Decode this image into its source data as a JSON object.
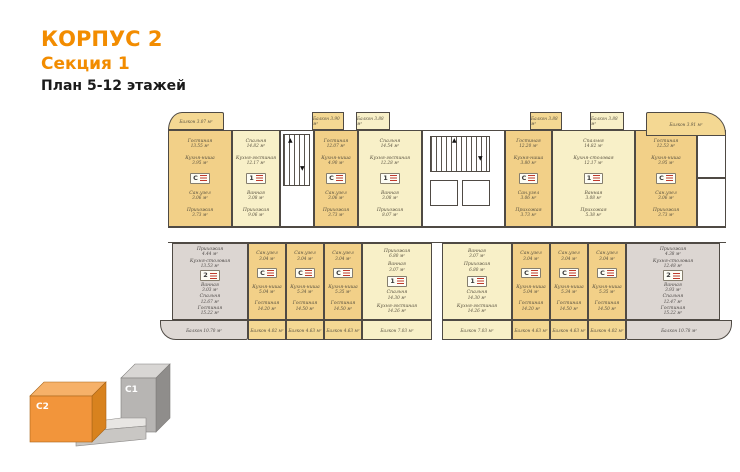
{
  "header": {
    "building": "КОРПУС 2",
    "section": "Секция 1",
    "plan_label": "План 5-12 этажей"
  },
  "key_plan": {
    "c2_label": "C2",
    "c1_label": "C1",
    "c2_color": "#F2953B",
    "c1_color": "#B7B5B3"
  },
  "plan": {
    "units": [
      {
        "id": "t1",
        "badge": "С",
        "rooms": [
          {
            "n": "Гостиная",
            "a": "13.55 м²"
          },
          {
            "n": "Кухня-ниша",
            "a": "3.95 м²"
          },
          {
            "n": "Сан.узел",
            "a": "3.06 м²"
          },
          {
            "n": "Прихожая",
            "a": "3.73 м²"
          }
        ]
      },
      {
        "id": "t2",
        "badge": "1",
        "rooms": [
          {
            "n": "Спальня",
            "a": "14.82 м²"
          },
          {
            "n": "Кухня-гостиная",
            "a": "12.17 м²"
          },
          {
            "n": "Ванная",
            "a": "3.08 м²"
          },
          {
            "n": "Прихожая",
            "a": "9.06 м²"
          }
        ]
      },
      {
        "id": "t3",
        "badge": "С",
        "rooms": [
          {
            "n": "Гостиная",
            "a": "12.07 м²"
          },
          {
            "n": "Кухня-ниша",
            "a": "4.90 м²"
          },
          {
            "n": "Сан.узел",
            "a": "3.06 м²"
          },
          {
            "n": "Прихожая",
            "a": "3.73 м²"
          }
        ]
      },
      {
        "id": "t4",
        "badge": "1",
        "rooms": [
          {
            "n": "Спальня",
            "a": "14.54 м²"
          },
          {
            "n": "Кухня-гостиная",
            "a": "12.28 м²"
          },
          {
            "n": "Ванная",
            "a": "3.08 м²"
          },
          {
            "n": "Прихожая",
            "a": "8.07 м²"
          }
        ]
      },
      {
        "id": "t5",
        "badge": "С",
        "rooms": [
          {
            "n": "Гостиная",
            "a": "12.20 м²"
          },
          {
            "n": "Кухня-ниша",
            "a": "3.80 м²"
          },
          {
            "n": "Сан.узел",
            "a": "3.06 м²"
          },
          {
            "n": "Прихожая",
            "a": "3.73 м²"
          }
        ]
      },
      {
        "id": "t6",
        "badge": "1",
        "rooms": [
          {
            "n": "Спальня",
            "a": "14.82 м²"
          },
          {
            "n": "Кухня-столовая",
            "a": "12.17 м²"
          },
          {
            "n": "Ванная",
            "a": "3.08 м²"
          },
          {
            "n": "Прихожая",
            "a": "5.38 м²"
          }
        ]
      },
      {
        "id": "t7",
        "badge": "С",
        "rooms": [
          {
            "n": "Гостиная",
            "a": "12.53 м²"
          },
          {
            "n": "Кухня-ниша",
            "a": "3.95 м²"
          },
          {
            "n": "Сан.узел",
            "a": "3.06 м²"
          },
          {
            "n": "Прихожая",
            "a": "3.73 м²"
          }
        ]
      },
      {
        "id": "g1",
        "badge": "2",
        "rooms": [
          {
            "n": "Прихожая",
            "a": "4.44 м²"
          },
          {
            "n": "Кухня-столовая",
            "a": "13.53 м²"
          },
          {
            "n": "Ванная",
            "a": "3.03 м²"
          },
          {
            "n": "Спальня",
            "a": "12.67 м²"
          },
          {
            "n": "Гостиная",
            "a": "15.22 м²"
          }
        ]
      },
      {
        "id": "s1",
        "badge": "С",
        "rooms": [
          {
            "n": "Сан.узел",
            "a": "3.04 м²"
          },
          {
            "n": "Кухня-ниша",
            "a": "5.04 м²"
          },
          {
            "n": "Гостиная",
            "a": "14.20 м²"
          }
        ]
      },
      {
        "id": "s2",
        "badge": "С",
        "rooms": [
          {
            "n": "Сан.узел",
            "a": "3.04 м²"
          },
          {
            "n": "Кухня-ниша",
            "a": "5.34 м²"
          },
          {
            "n": "Гостиная",
            "a": "14.50 м²"
          }
        ]
      },
      {
        "id": "s3",
        "badge": "С",
        "rooms": [
          {
            "n": "Сан.узел",
            "a": "3.04 м²"
          },
          {
            "n": "Кухня-ниша",
            "a": "5.35 м²"
          },
          {
            "n": "Гостиная",
            "a": "14.50 м²"
          }
        ]
      },
      {
        "id": "o1",
        "badge": "1",
        "rooms": [
          {
            "n": "Прихожая",
            "a": "6.80 м²"
          },
          {
            "n": "Ванная",
            "a": "3.07 м²"
          },
          {
            "n": "Спальня",
            "a": "14.30 м²"
          },
          {
            "n": "Кухня-гостиная",
            "a": "14.26 м²"
          }
        ]
      },
      {
        "id": "o2",
        "badge": "1",
        "rooms": [
          {
            "n": "Ванная",
            "a": "3.07 м²"
          },
          {
            "n": "Прихожая",
            "a": "6.80 м²"
          },
          {
            "n": "Спальня",
            "a": "14.30 м²"
          },
          {
            "n": "Кухня-гостиная",
            "a": "14.26 м²"
          }
        ]
      },
      {
        "id": "s4",
        "badge": "С",
        "rooms": [
          {
            "n": "Сан.узел",
            "a": "3.04 м²"
          },
          {
            "n": "Кухня-ниша",
            "a": "5.04 м²"
          },
          {
            "n": "Гостиная",
            "a": "14.20 м²"
          }
        ]
      },
      {
        "id": "s5",
        "badge": "С",
        "rooms": [
          {
            "n": "Сан.узел",
            "a": "3.04 м²"
          },
          {
            "n": "Кухня-ниша",
            "a": "5.34 м²"
          },
          {
            "n": "Гостиная",
            "a": "14.50 м²"
          }
        ]
      },
      {
        "id": "s6",
        "badge": "С",
        "rooms": [
          {
            "n": "Сан.узел",
            "a": "3.04 м²"
          },
          {
            "n": "Кухня-ниша",
            "a": "5.35 м²"
          },
          {
            "n": "Гостиная",
            "a": "14.50 м²"
          }
        ]
      },
      {
        "id": "g2",
        "badge": "2",
        "rooms": [
          {
            "n": "Прихожая",
            "a": "4.38 м²"
          },
          {
            "n": "Кухня-столовая",
            "a": "12.48 м²"
          },
          {
            "n": "Ванная",
            "a": "3.93 м²"
          },
          {
            "n": "Спальня",
            "a": "12.47 м²"
          },
          {
            "n": "Гостиная",
            "a": "15.22 м²"
          }
        ]
      }
    ],
    "balconies": [
      {
        "id": "tb1",
        "label": "Балкон",
        "area": "3.07 м²",
        "tone": "gold"
      },
      {
        "id": "tb2",
        "label": "Балкон",
        "area": "3.90 м²",
        "tone": "gold"
      },
      {
        "id": "tb3",
        "label": "Балкон",
        "area": "3.88 м²",
        "tone": "pale"
      },
      {
        "id": "tb4",
        "label": "Балкон",
        "area": "3.88 м²",
        "tone": "gold"
      },
      {
        "id": "tb5",
        "label": "Балкон",
        "area": "3.88 м²",
        "tone": "pale"
      },
      {
        "id": "tb6",
        "label": "Балкон",
        "area": "3.91 м²",
        "tone": "gold"
      },
      {
        "id": "bb1",
        "label": "Балкон",
        "area": "10.70 м²",
        "tone": "gray"
      },
      {
        "id": "bb2",
        "label": "Балкон",
        "area": "4.02 м²",
        "tone": "gold"
      },
      {
        "id": "bb3",
        "label": "Балкон",
        "area": "4.63 м²",
        "tone": "gold"
      },
      {
        "id": "bb4",
        "label": "Балкон",
        "area": "4.63 м²",
        "tone": "gold"
      },
      {
        "id": "bb5",
        "label": "Балкон",
        "area": "7.03 м²",
        "tone": "pale"
      },
      {
        "id": "bb6",
        "label": "Балкон",
        "area": "7.03 м²",
        "tone": "pale"
      },
      {
        "id": "bb7",
        "label": "Балкон",
        "area": "4.63 м²",
        "tone": "gold"
      },
      {
        "id": "bb8",
        "label": "Балкон",
        "area": "4.63 м²",
        "tone": "gold"
      },
      {
        "id": "bb9",
        "label": "Балкон",
        "area": "4.02 м²",
        "tone": "gold"
      },
      {
        "id": "bb10",
        "label": "Балкон",
        "area": "10.78 м²",
        "tone": "gray"
      }
    ]
  }
}
